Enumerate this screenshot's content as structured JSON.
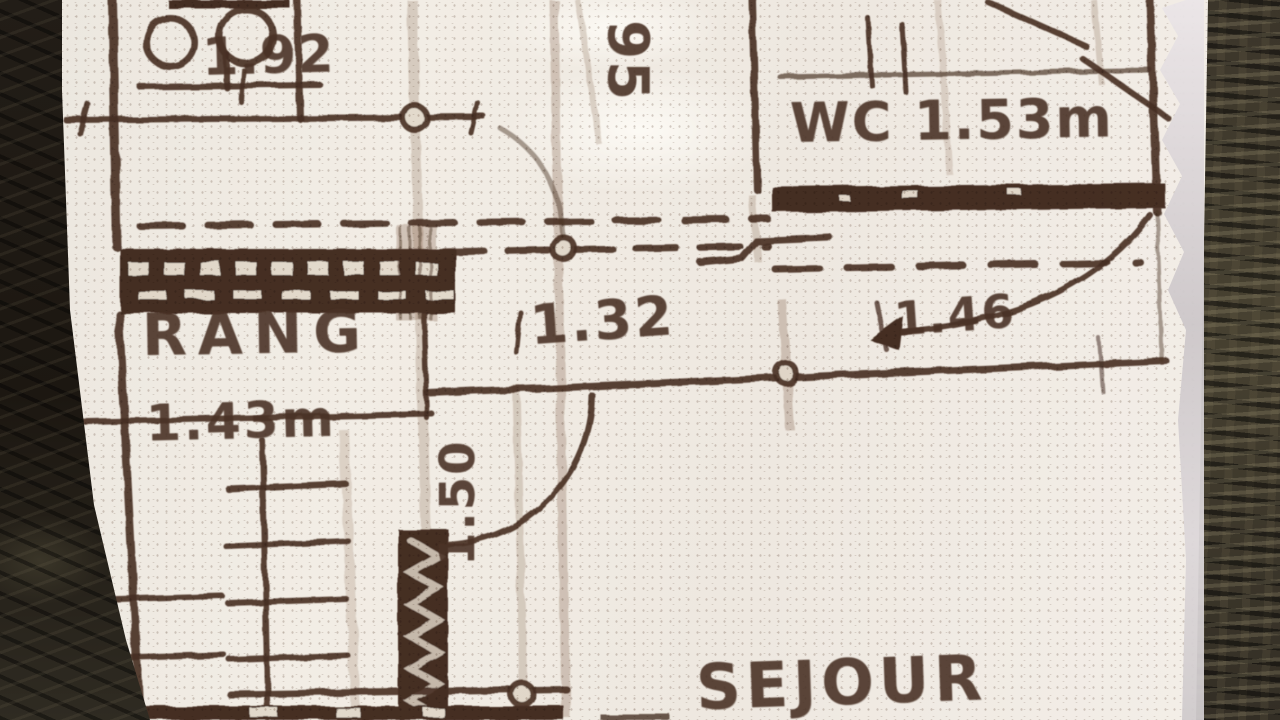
{
  "floorplan": {
    "room_labels": {
      "rang": "RANG",
      "rang_area": "1.43m",
      "wc": "WC 1.53m",
      "sejour": "SEJOUR"
    },
    "dimensions": {
      "top_left": "1.92",
      "top_mid_vertical": "95",
      "center": "1.32",
      "door_right": "1.46",
      "door_center_vertical": "1.50"
    },
    "colors": {
      "ink": "#4a3226",
      "paper": "#f0ebe3",
      "paper_edge_highlight": "#d6d1d3",
      "leather_dark": "#201b15",
      "leather_olive": "#3e382c"
    }
  }
}
